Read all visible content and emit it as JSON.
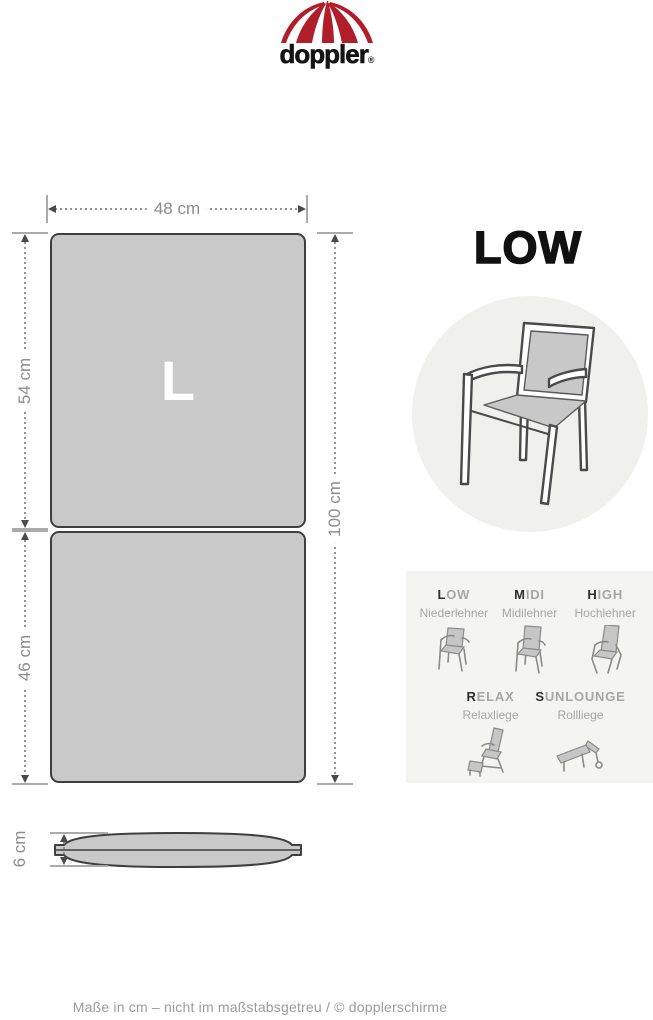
{
  "logo": {
    "brand": "doppler",
    "registered": "®"
  },
  "front_view": {
    "size_label": "L",
    "width_label": "48 cm",
    "back_height_label": "54 cm",
    "seat_height_label": "46 cm",
    "total_height_label": "100 cm",
    "thickness_label": "6 cm"
  },
  "product": {
    "category_title": "LOW"
  },
  "variants": [
    {
      "code_first": "L",
      "code_rest": "OW",
      "subtitle": "Niederlehner"
    },
    {
      "code_first": "M",
      "code_rest": "IDI",
      "subtitle": "Midilehner"
    },
    {
      "code_first": "H",
      "code_rest": "IGH",
      "subtitle": "Hochlehner"
    },
    {
      "code_first": "R",
      "code_rest": "ELAX",
      "subtitle": "Relaxliege"
    },
    {
      "code_first": "S",
      "code_rest": "UNLOUNGE",
      "subtitle": "Rollliege"
    }
  ],
  "footer": {
    "note": "Maße in cm – nicht im maßstabsgetreu / © dopplerschirme"
  },
  "colors": {
    "logo_red": "#b01f29",
    "cushion_fill": "#c9c9c9",
    "cushion_outline": "#3f3f3f",
    "dimension_gray": "#8c8c8c",
    "panel_background": "#f4f4f2",
    "circle_background": "#f0f0ee",
    "text_black": "#111111",
    "muted_gray": "#a6a6a6"
  }
}
